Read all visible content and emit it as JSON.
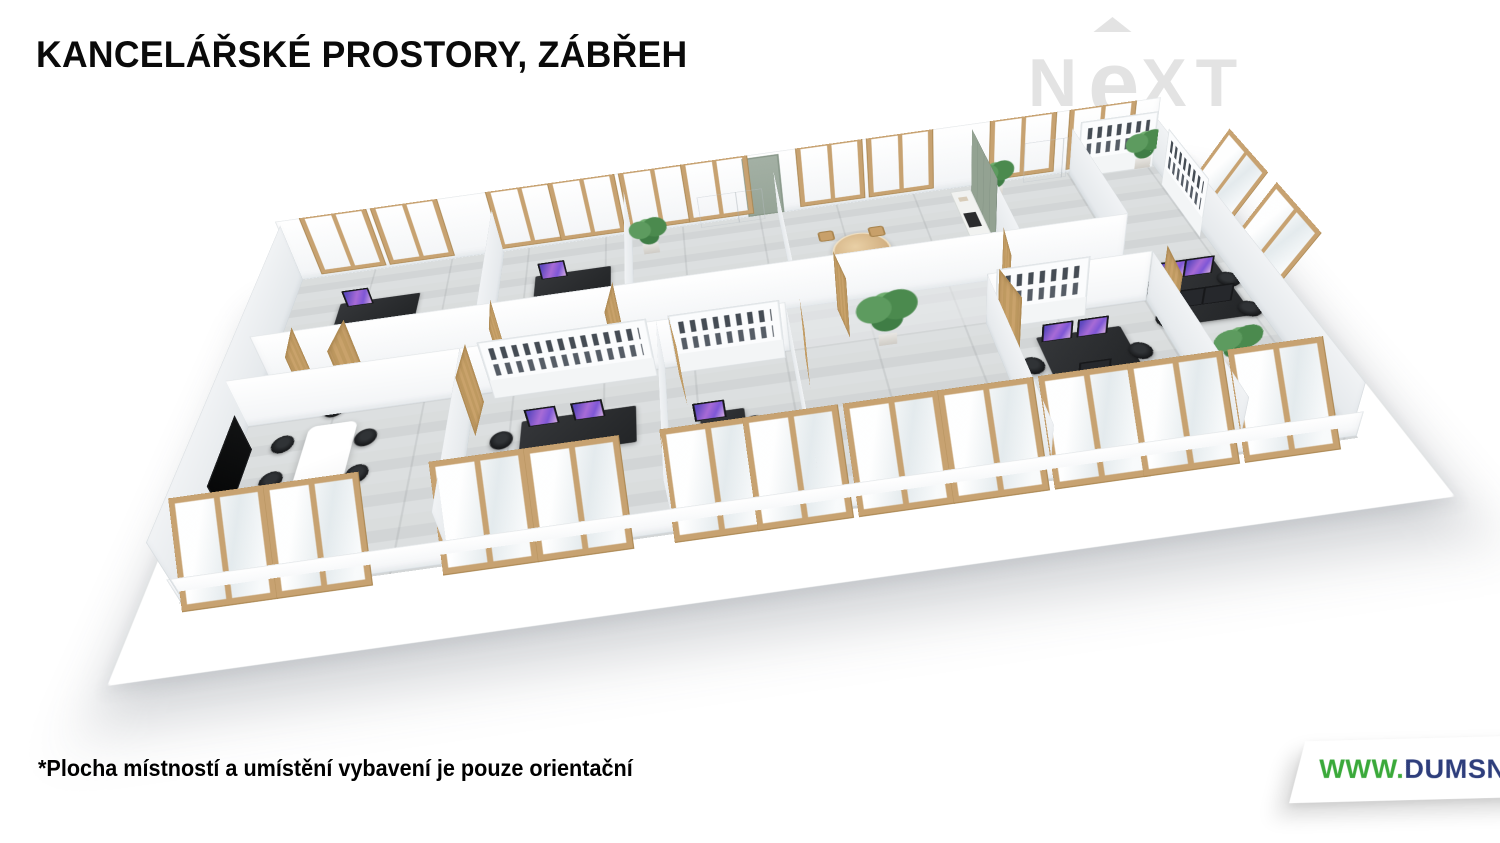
{
  "header": {
    "title": "KANCELÁŘSKÉ PROSTORY, ZÁBŘEH",
    "title_color": "#0a0a0a"
  },
  "watermark": {
    "full": "NEXT",
    "n": "N",
    "e": "e",
    "xt": "XT",
    "color": "#e3e3e3"
  },
  "floorplan": {
    "description": "3D rendered floor plan of office spaces with corridor, offices, meeting room and kitchen",
    "palette": {
      "wood_frame": "#c7a271",
      "wood_dark": "#a9854f",
      "floor_gray": "#d5d8d9",
      "wall_white": "#fbfcfd",
      "wall_shadow": "#e6eaed",
      "kitchen_sage": "#8f9e8e",
      "gray_door": "#9aa79b",
      "desk_dark": "#2c2e31",
      "monitor_screen_purple": "#7b5cd6",
      "tv_black": "#0b0c0d",
      "plant_green": "#4b8a4e"
    }
  },
  "footer": {
    "disclaimer": "*Plocha místností a umístění vybavení je pouze orientační",
    "website": {
      "part1": "WWW.",
      "part2": "DUMSNU.",
      "part3": "COM",
      "green": "#3aa93a",
      "navy": "#2e3e7c"
    }
  }
}
